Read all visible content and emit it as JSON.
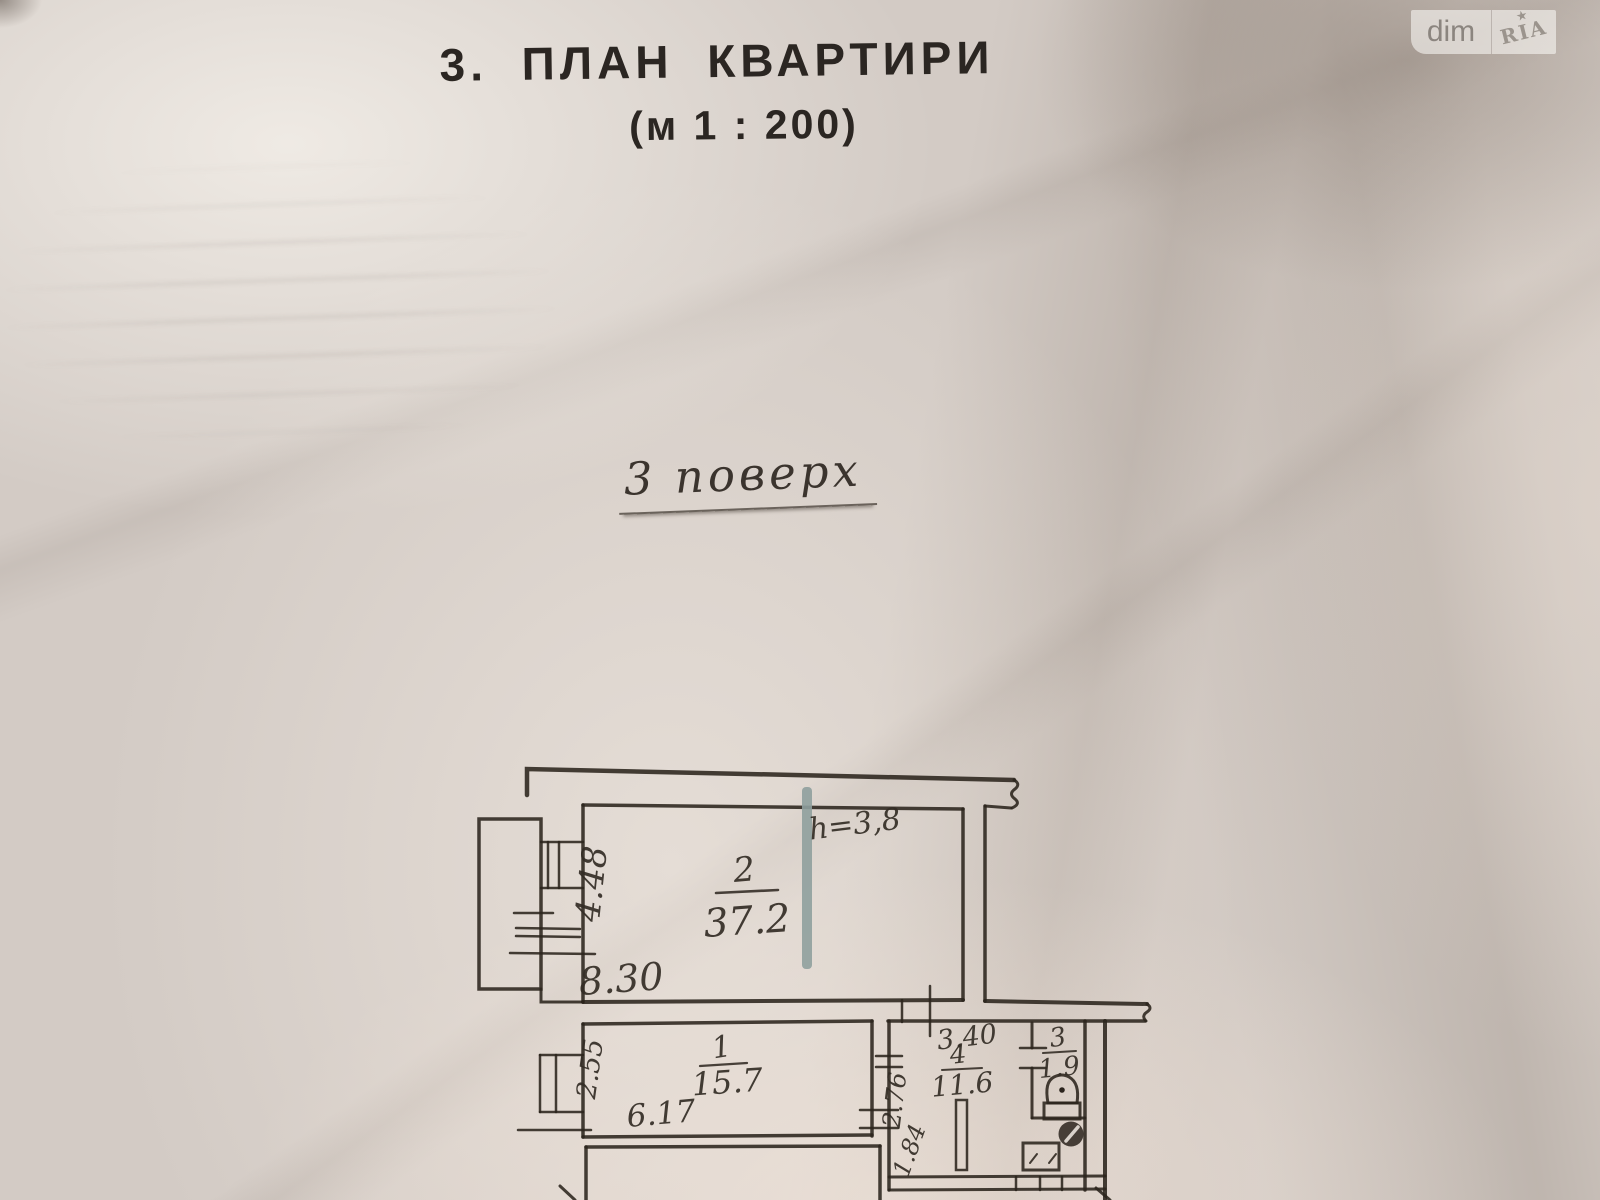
{
  "watermark": {
    "dim": "dim",
    "ria": "RIA",
    "star": "★"
  },
  "title": {
    "heading": "3. ПЛАН КВАРТИРИ",
    "scale": "(м 1 : 200)"
  },
  "floor_note": "3 поверх",
  "plan": {
    "room2": {
      "number": "2",
      "area": "37.2",
      "width": "8.30",
      "depth": "4.48",
      "height_note": "h=3,8"
    },
    "room1": {
      "number": "1",
      "area": "15.7",
      "width": "6.17",
      "depth": "2.55"
    },
    "room4": {
      "number": "4",
      "area": "11.6",
      "top_width": "3.40",
      "side_upper": "2.76",
      "side_lower": "1.84"
    },
    "room3": {
      "number": "3",
      "area": "1.9"
    }
  },
  "colors": {
    "ink": "#2b241d",
    "marker": "#8fa09d",
    "paper": "#d3cbc5"
  }
}
